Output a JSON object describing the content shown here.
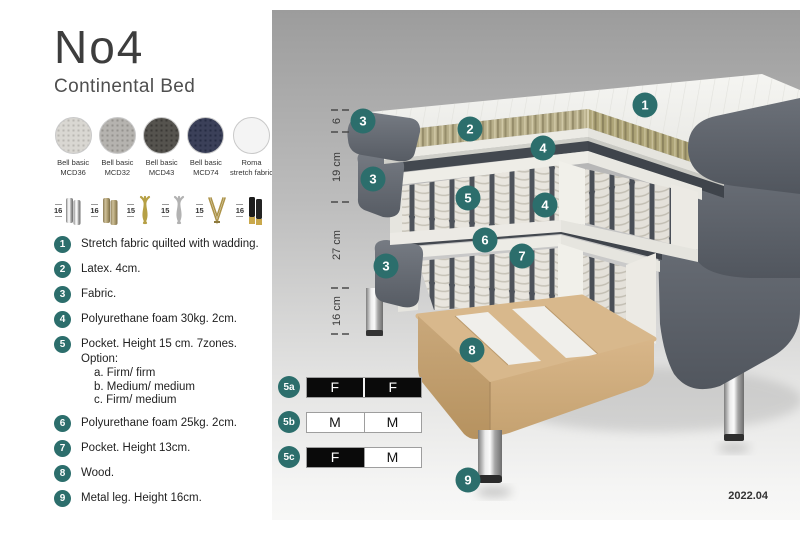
{
  "header": {
    "title": "No4",
    "subtitle": "Continental Bed"
  },
  "swatches": [
    {
      "line1": "Bell basic",
      "line2": "MCD36",
      "color": "#d9d7d2"
    },
    {
      "line1": "Bell basic",
      "line2": "MCD32",
      "color": "#b5b3af"
    },
    {
      "line1": "Bell basic",
      "line2": "MCD43",
      "color": "#55534e"
    },
    {
      "line1": "Bell basic",
      "line2": "MCD74",
      "color": "#3b4059"
    },
    {
      "line1": "Roma",
      "line2": "stretch fabric",
      "color": "#f4f4f4"
    }
  ],
  "legs": [
    {
      "size": "16",
      "type": "cylinder-silver"
    },
    {
      "size": "16",
      "type": "cylinder-brass"
    },
    {
      "size": "15",
      "type": "twist-gold"
    },
    {
      "size": "15",
      "type": "twist-silver"
    },
    {
      "size": "15",
      "type": "hairpin-gold"
    },
    {
      "size": "16",
      "type": "cylinder-black-gold"
    }
  ],
  "legend": {
    "items": [
      {
        "num": "1",
        "text": "Stretch fabric quilted with wadding."
      },
      {
        "num": "2",
        "text": "Latex. 4cm."
      },
      {
        "num": "3",
        "text": "Fabric."
      },
      {
        "num": "4",
        "text": "Polyurethane foam 30kg. 2cm."
      },
      {
        "num": "5",
        "text": "Pocket. Height 15 cm. 7zones. Option:",
        "options": [
          "a. Firm/ firm",
          "b. Medium/ medium",
          "c. Firm/ medium"
        ]
      },
      {
        "num": "6",
        "text": "Polyurethane foam 25kg. 2cm."
      },
      {
        "num": "7",
        "text": "Pocket. Height 13cm."
      },
      {
        "num": "8",
        "text": "Wood."
      },
      {
        "num": "9",
        "text": "Metal leg. Height 16cm."
      }
    ]
  },
  "diagram": {
    "callouts": [
      {
        "num": "1"
      },
      {
        "num": "2"
      },
      {
        "num": "3"
      },
      {
        "num": "4"
      },
      {
        "num": "3"
      },
      {
        "num": "5"
      },
      {
        "num": "4"
      },
      {
        "num": "6"
      },
      {
        "num": "7"
      },
      {
        "num": "3"
      },
      {
        "num": "8"
      },
      {
        "num": "9"
      }
    ],
    "dimensions": [
      {
        "label": "6"
      },
      {
        "label": "19 cm"
      },
      {
        "label": "27 cm"
      },
      {
        "label": "16 cm"
      }
    ]
  },
  "firmness": {
    "rows": [
      {
        "label": "5a",
        "cells": [
          {
            "text": "F",
            "variant": "dark"
          },
          {
            "text": "F",
            "variant": "dark"
          }
        ]
      },
      {
        "label": "5b",
        "cells": [
          {
            "text": "M",
            "variant": "light"
          },
          {
            "text": "M",
            "variant": "light"
          }
        ]
      },
      {
        "label": "5c",
        "cells": [
          {
            "text": "F",
            "variant": "dark"
          },
          {
            "text": "M",
            "variant": "light"
          }
        ]
      }
    ]
  },
  "version": "2022.04",
  "colors": {
    "accent_teal": "#2c6e6c",
    "fabric_dark": "#565b63",
    "latex_tan": "#b6ad88",
    "wood": "#d9b88c",
    "chrome": "#c9c9c9"
  }
}
